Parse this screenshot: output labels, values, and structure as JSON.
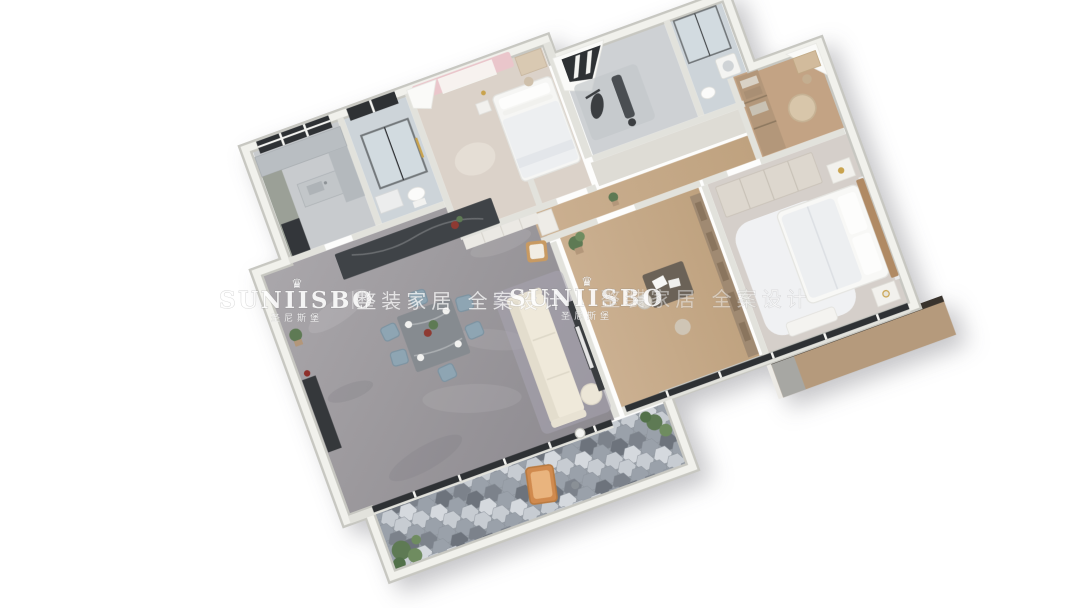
{
  "scene": {
    "description": "3D rendered isometric floor plan of a furnished apartment, rotated on white background",
    "background": "#ffffff",
    "rotation_deg": -20
  },
  "watermarks": {
    "left": {
      "crown": "♛",
      "brand": "SUNIISBO",
      "brand_cn": "圣尼斯堡",
      "tagline": "整装家居 全案设计"
    },
    "right": {
      "crown": "♛",
      "brand": "SUNIISBO",
      "brand_cn": "圣尼斯堡",
      "tagline": "整装家居 全案设计"
    }
  },
  "palette": {
    "wall_outer": "#c7c7c1",
    "wall_top": "#f1f1ec",
    "wall_inner": "#e2e2dc",
    "marble_floor": "#a09da1",
    "wood_floor": "#c5a98a",
    "warm_wood": "#b3977a",
    "bedroom_floor": "#dbd2c9",
    "master_floor": "#d5cfca",
    "bath_floor": "#cdd4d9",
    "gym_floor": "#ced1d4",
    "hex_dark": "#7c828b",
    "hex_mid": "#9aa1aa",
    "hex_light": "#c7ccd2",
    "hex_pale": "#d5d9de",
    "hex_deep": "#6d737c",
    "sofa_cream": "#efe9da",
    "accent_orange": "#d08a4e",
    "chair_blue": "#8ea5b3",
    "island_dark": "#3f4347",
    "curtain_pink": "#eac6cb",
    "plant_green": "#5e7a54",
    "ledge_tan": "#b59a7c",
    "glazing_dark": "#2e3134",
    "headboard_wood": "#b08a64",
    "gold": "#c9a34e"
  },
  "rooms": [
    {
      "name": "living-dining-room",
      "floor": "gray marble"
    },
    {
      "name": "open-kitchen",
      "floor": "gray tile"
    },
    {
      "name": "bathroom",
      "floor": "blue-gray tile"
    },
    {
      "name": "secondary-bedroom",
      "floor": "light wood, pink curtains"
    },
    {
      "name": "fitness-room",
      "floor": "gray tile, skylight"
    },
    {
      "name": "shower-room",
      "floor": "blue-gray tile"
    },
    {
      "name": "hallway",
      "floor": "oak wood"
    },
    {
      "name": "walk-in-closet",
      "floor": "oak wood"
    },
    {
      "name": "study-tea-room",
      "floor": "oak wood"
    },
    {
      "name": "master-bedroom",
      "floor": "light greige"
    },
    {
      "name": "leisure-balcony",
      "floor": "hexagonal gray tiles"
    },
    {
      "name": "service-ledge",
      "floor": "tan"
    }
  ]
}
